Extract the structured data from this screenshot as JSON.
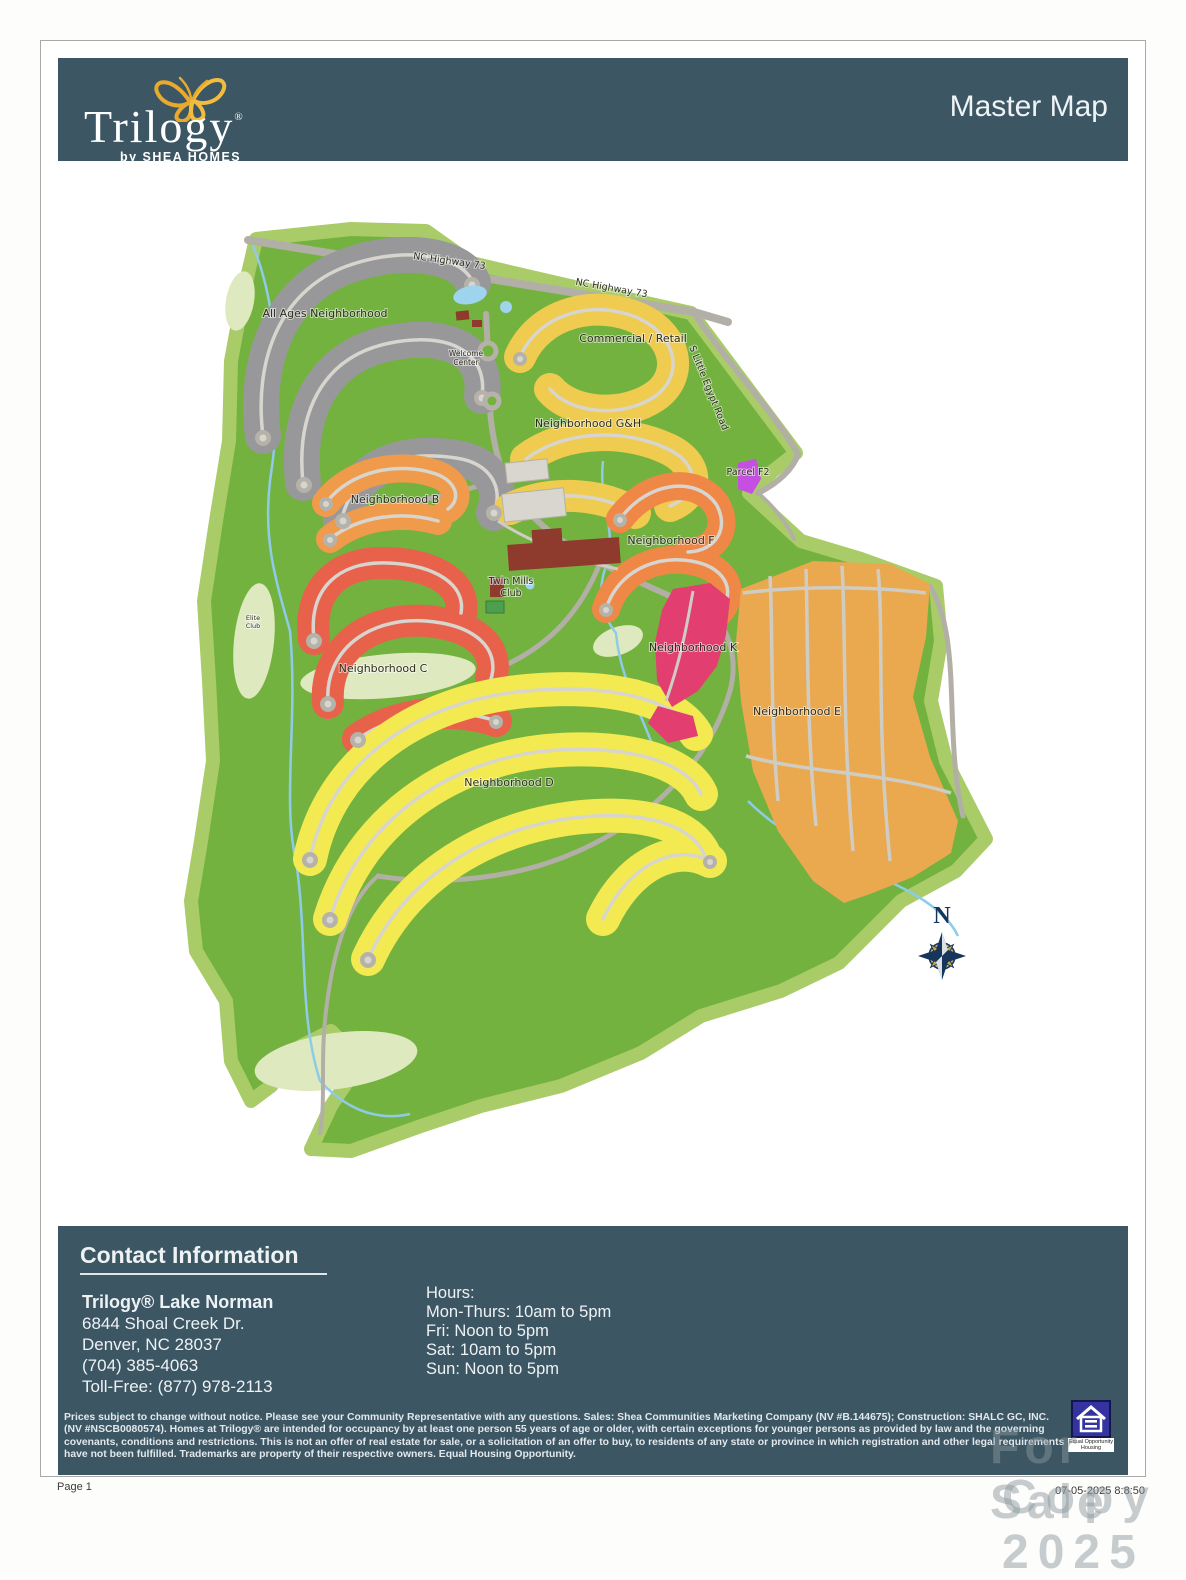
{
  "header": {
    "brand": "Trilogy",
    "brand_mark": "®",
    "tagline": "by SHEA HOMES",
    "page_title": "Master Map",
    "bg_color": "#3c5664",
    "butterfly_color": "#e9a92c"
  },
  "map": {
    "labels": {
      "highway_a": "NC Highway 73",
      "highway_b": "NC Highway 73",
      "egypt_road": "S Little Egypt Road",
      "all_ages": "All Ages Neighborhood",
      "commercial": "Commercial / Retail",
      "welcome_1": "Welcome",
      "welcome_2": "Center",
      "gh": "Neighborhood G&H",
      "b": "Neighborhood B",
      "c": "Neighborhood C",
      "d": "Neighborhood D",
      "e": "Neighborhood E",
      "f": "Neighborhood F",
      "k": "Neighborhood K",
      "parcel_f2": "Parcel F2",
      "twin_1": "Twin Mills",
      "twin_2": "Club",
      "elite_1": "Elite",
      "elite_2": "Club",
      "compass_n": "N"
    },
    "colors": {
      "green_main": "#74b23f",
      "green_fringe": "#a9cc68",
      "green_pale": "#dfe9c0",
      "road": "#b5b2a9",
      "all_ages_gray": "#98989a",
      "gh_yellow": "#efcb4f",
      "b_orange": "#f09a4c",
      "c_red": "#e8614b",
      "f_orange": "#ef8747",
      "k_pink": "#e23f70",
      "e_amber": "#eaa94e",
      "d_yellow": "#f2ea50",
      "parcel_f2_purple": "#c44fe0",
      "club_brown": "#8e3a2c",
      "creek_blue": "#8ecbe8",
      "compass_navy": "#16355a",
      "compass_gold": "#c9a74e"
    }
  },
  "contact": {
    "heading": "Contact Information",
    "name": "Trilogy® Lake Norman",
    "address1": "6844 Shoal Creek Dr.",
    "address2": "Denver, NC 28037",
    "phone": "(704) 385-4063",
    "tollfree": "Toll-Free: (877) 978-2113",
    "hours_heading": "Hours:",
    "hours": [
      "Mon-Thurs: 10am to 5pm",
      "Fri: Noon to 5pm",
      "Sat: 10am to 5pm",
      "Sun: Noon to 5pm"
    ]
  },
  "legal": {
    "disclaimer": "Prices subject to change without notice. Please see your Community Representative with any questions. Sales: Shea Communities Marketing Company (NV #B.144675); Construction: SHALC GC, INC. (NV #NSCB0080574). Homes at Trilogy® are intended for occupancy by at least one person 55 years of age or older, with certain exceptions for younger persons as provided by law and the governing covenants, conditions and restrictions. This is not an offer of real estate for sale, or a solicitation of an offer to buy, to residents of any state or province in which registration and other legal requirements have not been fulfilled. Trademarks are property of their respective owners. Equal Housing Opportunity.",
    "equal_housing_line1": "Equal Opportunity",
    "equal_housing_line2": "Housing"
  },
  "watermark": {
    "line1": "For Sale",
    "line2": "Copy 2025"
  },
  "footer": {
    "page": "Page 1",
    "timestamp": "07-05-2025 8:8:50"
  }
}
